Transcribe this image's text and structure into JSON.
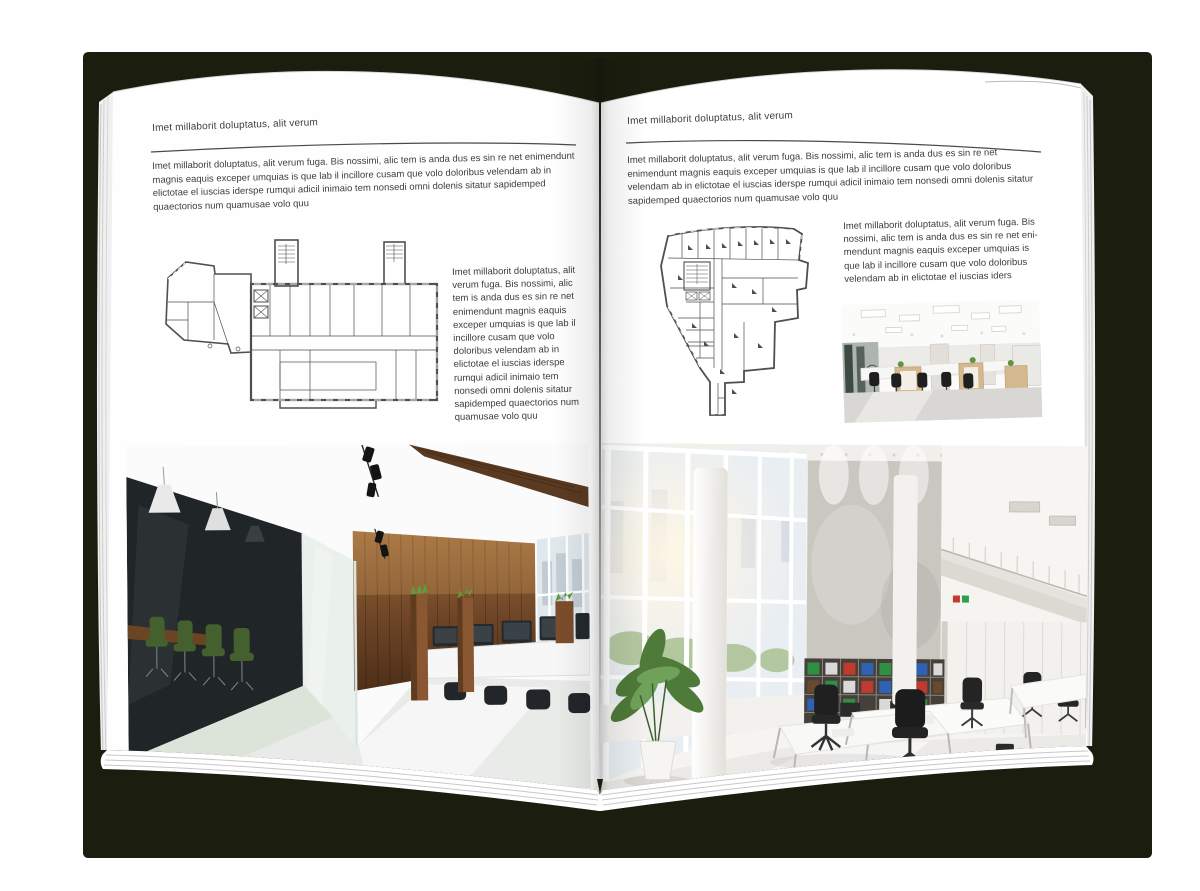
{
  "colors": {
    "cover": "#1b1d0e",
    "page": "#ffffff",
    "body_text": "#3d3d3d",
    "plan_line": "#4f4f4f"
  },
  "left_page": {
    "header": "Imet millaborit doluptatus, alit verum",
    "intro": "Imet millaborit doluptatus, alit verum fuga. Bis nossimi, alic tem is anda dus es sin re net enimendunt magnis eaquis exceper umquias is que lab il incillore cusam que volo doloribus velendam ab in elictotae el iuscias iderspe rumqui adicil inimaio tem nonsedi omni dolenis sitatur sapidemped quaectorios num quamusae volo quu",
    "side_text": "Imet millaborit doluptatus, alit verum fuga. Bis nossimi, alic tem is anda dus es sin re net enimendunt magnis eaquis exceper umquias is que lab il incillore cusam que volo doloribus velendam ab in elictotae el iuscias iderspe rumqui adicil inimaio tem nonsedi omni dolenis sitatur sapidemped quaectorios num quamusae volo quu"
  },
  "right_page": {
    "header": "Imet millaborit doluptatus, alit verum",
    "intro": "Imet millaborit doluptatus, alit verum fuga. Bis nossimi, alic tem is anda dus es sin re net enimendunt magnis eaquis exceper umquias is que lab il incillore cusam que volo doloribus velendam ab in elictotae el iuscias iderspe rumqui adicil inimaio tem nonsedi omni dolenis sitatur sapidemped quaectorios num quamusae volo quu",
    "side_text": "Imet millaborit doluptatus, alit verum fuga. Bis nossimi, alic tem is anda dus es sin re net eni-mendunt magnis eaquis exceper umquias is que lab il incillore cusam que volo doloribus velendam ab in elictotae el iuscias iders"
  }
}
